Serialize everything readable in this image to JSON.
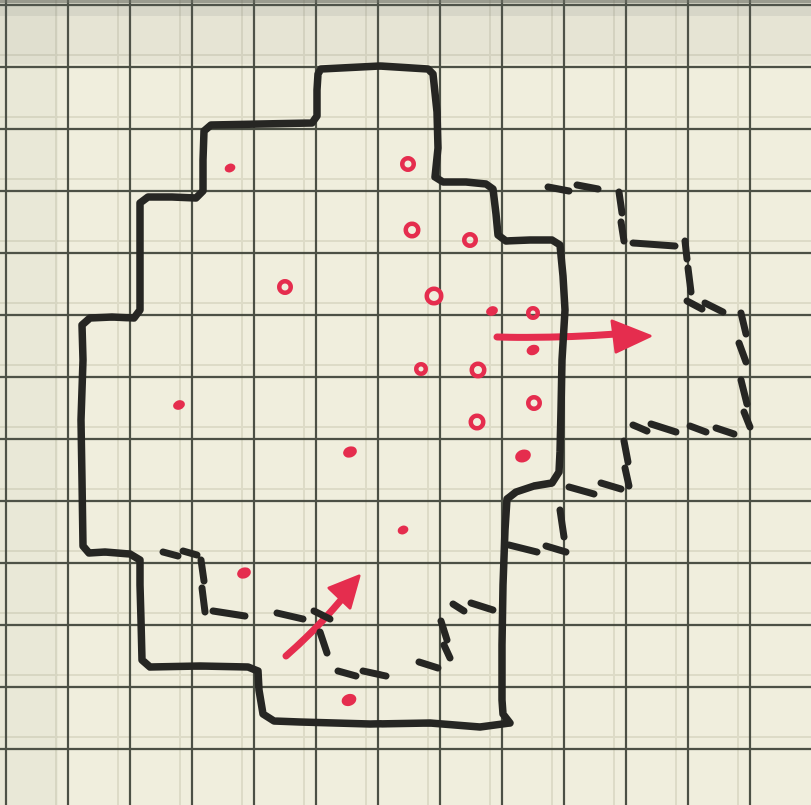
{
  "scene": {
    "description": "hand-drawn sketch map on graph paper",
    "canvas": {
      "width": 811,
      "height": 805
    }
  },
  "palette": {
    "paper": "#f0eedd",
    "grid_line": "#3f4339",
    "grid_ghost": "#d2cfba",
    "ink": "#262623",
    "red": "#e52d4e",
    "scan_edge": "#6b6e63",
    "shade_top": "rgba(110,120,110,0.08)",
    "shade_band": "rgba(90,100,95,0.10)",
    "shade_left": "rgba(120,130,120,0.05)"
  },
  "grid": {
    "spacing": 62,
    "x0": 6,
    "y0": 5,
    "line_width": 2.2,
    "ghost_offset": -12,
    "ghost_width": 2,
    "ghost_opacity": 0.6
  },
  "drawing": {
    "solid_outline": {
      "stroke_width": 7.5,
      "points": [
        [
          321,
          69
        ],
        [
          380,
          66
        ],
        [
          428,
          69
        ],
        [
          433,
          74
        ],
        [
          437,
          112
        ],
        [
          438,
          148
        ],
        [
          435,
          177
        ],
        [
          443,
          182
        ],
        [
          466,
          182
        ],
        [
          486,
          184
        ],
        [
          493,
          189
        ],
        [
          496,
          214
        ],
        [
          498,
          235
        ],
        [
          506,
          241
        ],
        [
          530,
          240
        ],
        [
          552,
          240
        ],
        [
          560,
          245
        ],
        [
          563,
          276
        ],
        [
          565,
          310
        ],
        [
          562,
          360
        ],
        [
          561,
          410
        ],
        [
          560,
          452
        ],
        [
          559,
          472
        ],
        [
          552,
          483
        ],
        [
          534,
          486
        ],
        [
          516,
          492
        ],
        [
          507,
          499
        ],
        [
          505,
          530
        ],
        [
          503,
          585
        ],
        [
          502,
          645
        ],
        [
          502,
          700
        ],
        [
          503,
          714
        ],
        [
          510,
          723
        ],
        [
          480,
          727
        ],
        [
          430,
          723
        ],
        [
          370,
          724
        ],
        [
          300,
          722
        ],
        [
          274,
          721
        ],
        [
          263,
          714
        ],
        [
          259,
          690
        ],
        [
          258,
          671
        ],
        [
          248,
          667
        ],
        [
          200,
          666
        ],
        [
          150,
          667
        ],
        [
          142,
          660
        ],
        [
          141,
          620
        ],
        [
          140,
          585
        ],
        [
          140,
          560
        ],
        [
          130,
          554
        ],
        [
          105,
          552
        ],
        [
          89,
          553
        ],
        [
          83,
          546
        ],
        [
          82,
          480
        ],
        [
          81,
          420
        ],
        [
          83,
          360
        ],
        [
          82,
          325
        ],
        [
          90,
          318
        ],
        [
          112,
          317
        ],
        [
          134,
          318
        ],
        [
          140,
          310
        ],
        [
          140,
          260
        ],
        [
          140,
          203
        ],
        [
          148,
          197
        ],
        [
          172,
          197
        ],
        [
          196,
          198
        ],
        [
          203,
          191
        ],
        [
          203,
          160
        ],
        [
          204,
          131
        ],
        [
          211,
          125
        ],
        [
          260,
          124
        ],
        [
          312,
          123
        ],
        [
          317,
          116
        ],
        [
          317,
          90
        ],
        [
          318,
          74
        ]
      ]
    },
    "dashed_annex": {
      "stroke_width": 7,
      "segments": [
        [
          548,
          187,
          569,
          191
        ],
        [
          577,
          185,
          598,
          189
        ],
        [
          619,
          192,
          622,
          213
        ],
        [
          621,
          222,
          624,
          241
        ],
        [
          633,
          243,
          675,
          246
        ],
        [
          685,
          241,
          687,
          259
        ],
        [
          688,
          268,
          691,
          292
        ],
        [
          687,
          301,
          702,
          309
        ],
        [
          705,
          303,
          723,
          312
        ],
        [
          741,
          313,
          746,
          334
        ],
        [
          739,
          343,
          746,
          362
        ],
        [
          741,
          380,
          747,
          404
        ],
        [
          744,
          412,
          750,
          427
        ],
        [
          633,
          425,
          647,
          431
        ],
        [
          651,
          424,
          676,
          432
        ],
        [
          690,
          426,
          706,
          432
        ],
        [
          716,
          428,
          734,
          434
        ],
        [
          624,
          441,
          628,
          462
        ],
        [
          625,
          468,
          629,
          486
        ],
        [
          601,
          483,
          621,
          489
        ],
        [
          569,
          487,
          594,
          494
        ]
      ]
    },
    "dashed_cell": {
      "stroke_width": 7,
      "segments": [
        [
          560,
          510,
          564,
          537
        ],
        [
          546,
          546,
          566,
          552
        ],
        [
          509,
          545,
          537,
          552
        ]
      ]
    },
    "dashed_interior": {
      "stroke_width": 7,
      "segments": [
        [
          163,
          552,
          178,
          556
        ],
        [
          183,
          551,
          197,
          555
        ],
        [
          201,
          560,
          204,
          581
        ],
        [
          202,
          588,
          205,
          612
        ],
        [
          213,
          611,
          245,
          616
        ],
        [
          277,
          613,
          303,
          619
        ],
        [
          314,
          611,
          330,
          619
        ],
        [
          320,
          632,
          327,
          653
        ],
        [
          338,
          671,
          356,
          676
        ],
        [
          363,
          671,
          386,
          676
        ],
        [
          419,
          662,
          438,
          668
        ],
        [
          441,
          621,
          447,
          640
        ],
        [
          444,
          645,
          450,
          658
        ],
        [
          453,
          604,
          464,
          611
        ],
        [
          471,
          603,
          493,
          610
        ]
      ]
    },
    "dots": [
      {
        "x": 230,
        "y": 168,
        "style": "filled",
        "r": 5.5
      },
      {
        "x": 408,
        "y": 164,
        "style": "open",
        "r": 8
      },
      {
        "x": 412,
        "y": 230,
        "style": "open",
        "r": 8.5
      },
      {
        "x": 470,
        "y": 240,
        "style": "open",
        "r": 8
      },
      {
        "x": 285,
        "y": 287,
        "style": "open",
        "r": 8
      },
      {
        "x": 434,
        "y": 296,
        "style": "open",
        "r": 9.5
      },
      {
        "x": 492,
        "y": 311,
        "style": "filled",
        "r": 6
      },
      {
        "x": 533,
        "y": 313,
        "style": "open",
        "r": 7
      },
      {
        "x": 533,
        "y": 350,
        "style": "filled",
        "r": 6.5
      },
      {
        "x": 421,
        "y": 369,
        "style": "open",
        "r": 7
      },
      {
        "x": 478,
        "y": 370,
        "style": "open",
        "r": 8.5
      },
      {
        "x": 534,
        "y": 403,
        "style": "open",
        "r": 8
      },
      {
        "x": 477,
        "y": 422,
        "style": "open",
        "r": 8.5
      },
      {
        "x": 523,
        "y": 456,
        "style": "filled",
        "r": 8
      },
      {
        "x": 350,
        "y": 452,
        "style": "filled",
        "r": 7
      },
      {
        "x": 403,
        "y": 530,
        "style": "filled",
        "r": 5.5
      },
      {
        "x": 244,
        "y": 573,
        "style": "filled",
        "r": 7
      },
      {
        "x": 179,
        "y": 405,
        "style": "filled",
        "r": 6
      },
      {
        "x": 349,
        "y": 700,
        "style": "filled",
        "r": 7.5
      }
    ],
    "arrows": [
      {
        "name": "arrow-east",
        "shaft": [
          [
            497,
            337
          ],
          [
            616,
            334
          ]
        ],
        "head": [
          [
            650,
            336
          ],
          [
            612,
            321
          ],
          [
            616,
            352
          ]
        ],
        "width": 7
      },
      {
        "name": "arrow-northeast",
        "shaft": [
          [
            286,
            656
          ],
          [
            341,
            600
          ]
        ],
        "head": [
          [
            359,
            576
          ],
          [
            329,
            588
          ],
          [
            350,
            608
          ]
        ],
        "width": 7
      }
    ]
  }
}
